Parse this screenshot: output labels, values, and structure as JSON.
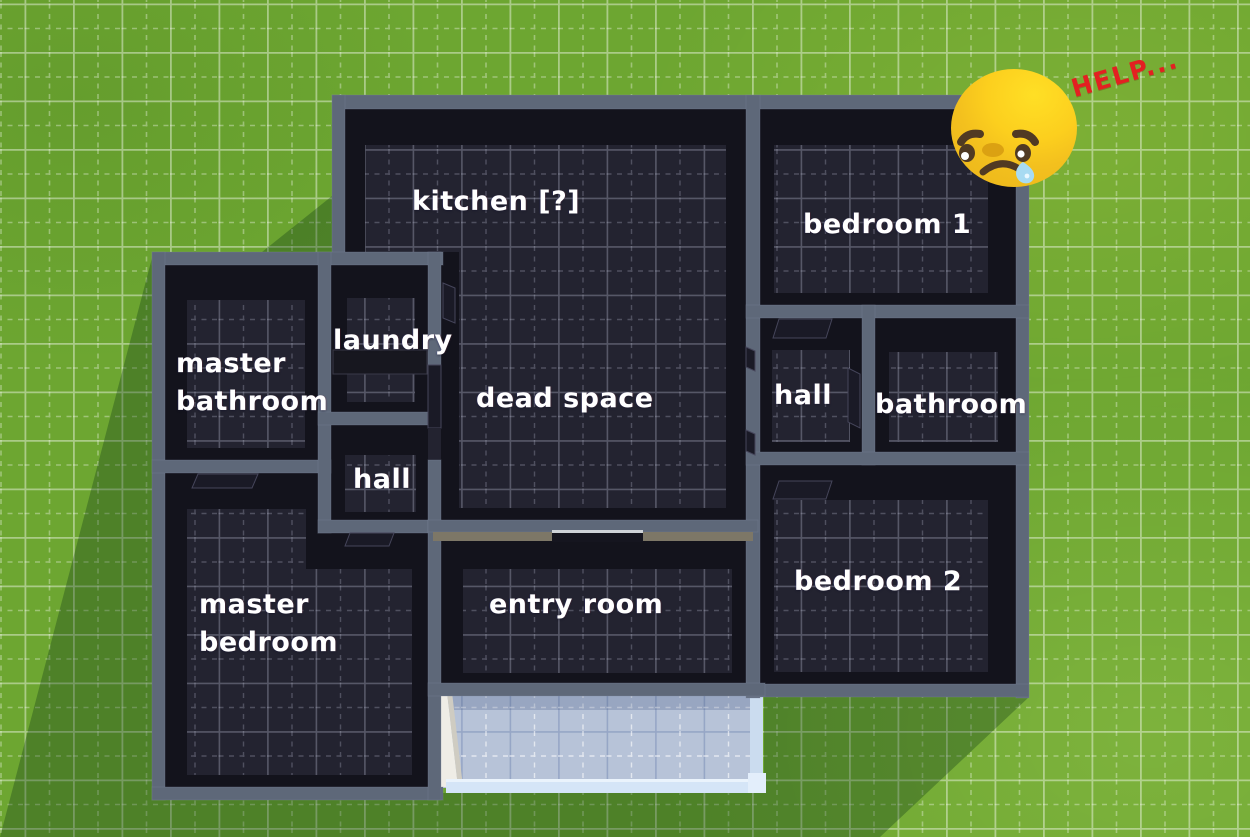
{
  "rooms": [
    {
      "id": "kitchen",
      "label": "kitchen [?]"
    },
    {
      "id": "bedroom-1",
      "label": "bedroom 1"
    },
    {
      "id": "laundry",
      "label": "laundry"
    },
    {
      "id": "master-bathroom",
      "label": "master\nbathroom"
    },
    {
      "id": "dead-space",
      "label": "dead space"
    },
    {
      "id": "hall-upper",
      "label": "hall"
    },
    {
      "id": "bathroom",
      "label": "bathroom"
    },
    {
      "id": "hall-lower",
      "label": "hall"
    },
    {
      "id": "master-bedroom",
      "label": "master\nbedroom"
    },
    {
      "id": "entry-room",
      "label": "entry room"
    },
    {
      "id": "bedroom-2",
      "label": "bedroom 2"
    }
  ],
  "annotation": {
    "help_text": "HELP...",
    "emoji": "crying-sad-face"
  },
  "colors": {
    "grass": "#6da631",
    "wall": "#5e6879",
    "wall_lit": "#7d7767",
    "floor": "#232330",
    "floor_dark": "#13131c",
    "door": "#1a1a26",
    "porch_floor": "#b7c3d8",
    "porch_rail": "#d5e5f7",
    "porch_wall_white": "#efede6",
    "label": "#ffffff",
    "help": "#e32021",
    "emoji_yellow": "#f3c01e",
    "emoji_bright": "#ffdd25",
    "emoji_brown": "#503a23",
    "emoji_nose": "#dba112",
    "tear": "#a8dbf2"
  }
}
